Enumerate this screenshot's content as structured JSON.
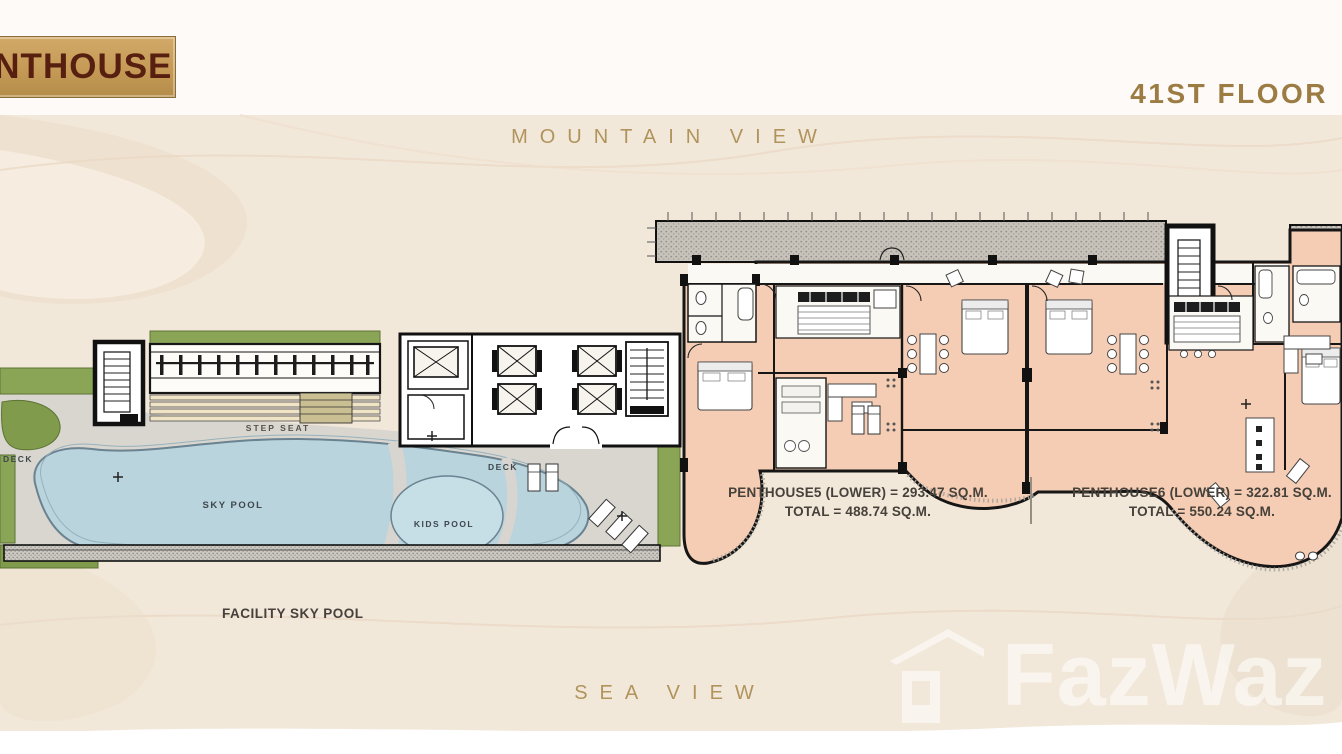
{
  "header": {
    "badge_label": "PENTHOUSE",
    "floor_label": "41ST FLOOR"
  },
  "views": {
    "mountain": "MOUNTAIN VIEW",
    "sea": "SEA VIEW"
  },
  "plan": {
    "facility_caption": "FACILITY SKY POOL",
    "sky_pool_label": "SKY POOL",
    "kids_pool_label": "KIDS POOL",
    "deck_label_left": "DECK",
    "deck_label_right": "DECK",
    "step_seat_label": "STEP SEAT",
    "units": [
      {
        "area_line": "PENTHOUSE5 (LOWER) = 293.47 SQ.M.",
        "total_line": "TOTAL = 488.74 SQ.M."
      },
      {
        "area_line": "PENTHOUSE6 (LOWER) = 322.81 SQ.M.",
        "total_line": "TOTAL = 550.24 SQ.M."
      }
    ]
  },
  "watermark": {
    "brand": "FazWaz"
  },
  "colors": {
    "accent_gold": "#a98a4f",
    "badge_gold": "#c59a56",
    "badge_text": "#571f10",
    "background_cream": "#f2e8da",
    "room_peach": "#f5cdb4",
    "pool_blue": "#b9d4dc",
    "landscape_green": "#8ba557",
    "deck_gray": "#d9d6d0",
    "wall_black": "#161616"
  }
}
